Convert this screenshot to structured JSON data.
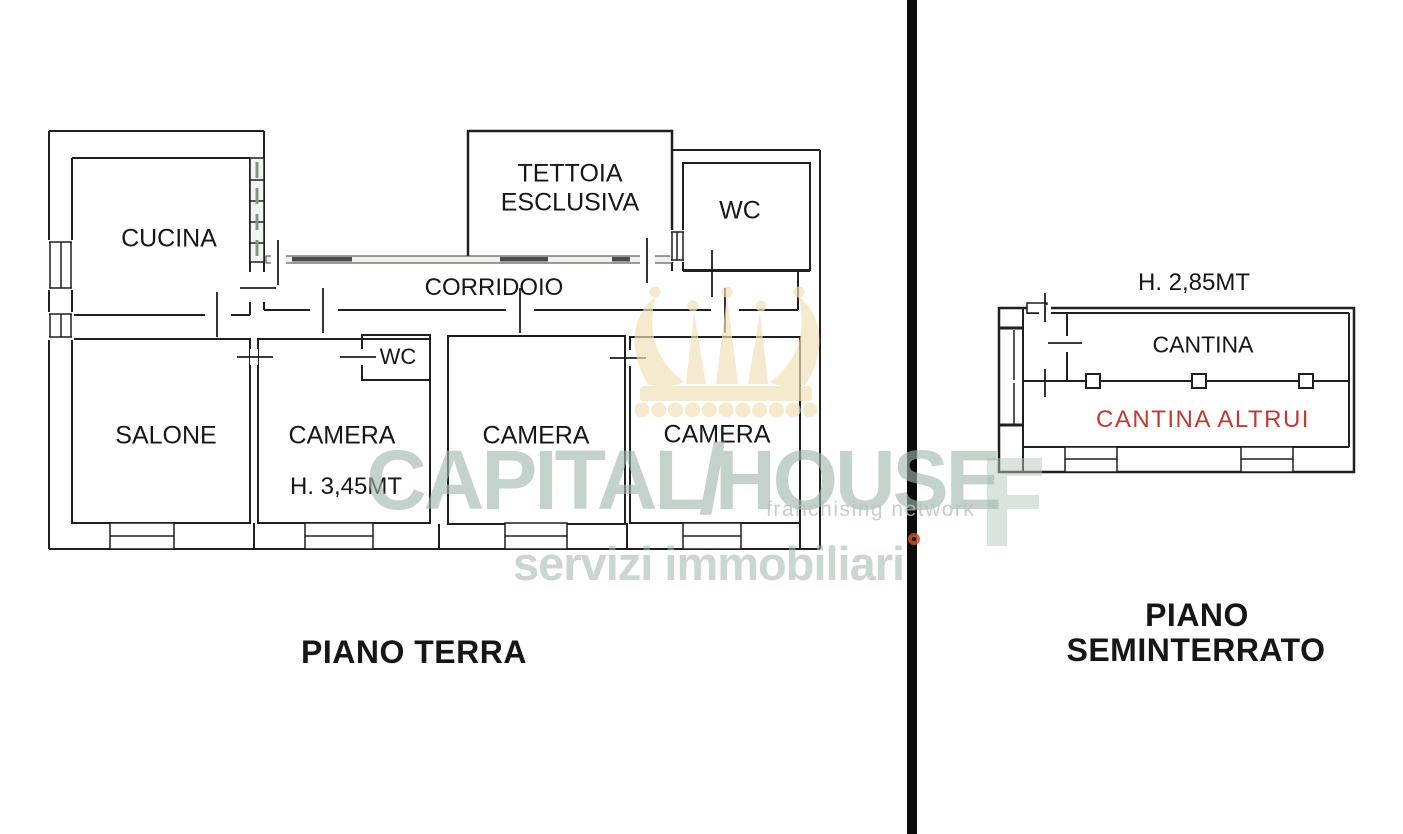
{
  "page": {
    "background": "#ffffff"
  },
  "divider": {
    "color": "#0b0b0b"
  },
  "ground_floor": {
    "title": "PIANO TERRA",
    "labels": {
      "cucina": "CUCINA",
      "tettoia_line1": "TETTOIA",
      "tettoia_line2": "ESCLUSIVA",
      "wc_top": "WC",
      "corridoio": "CORRIDOIO",
      "salone": "SALONE",
      "camera_1": "CAMERA",
      "wc_small": "WC",
      "height_note": "H. 3,45MT",
      "camera_2": "CAMERA",
      "camera_3": "CAMERA"
    }
  },
  "basement": {
    "title_line1": "PIANO",
    "title_line2": "SEMINTERRATO",
    "height_note": "H. 2,85MT",
    "labels": {
      "cantina": "CANTINA",
      "cantina_altrui": "CANTINA ALTRUI"
    },
    "cantina_altrui_color": "#c23a32"
  },
  "watermark": {
    "brand_left": "CAPITAL",
    "brand_slash": "/",
    "brand_right": "HOUSE",
    "tagline": "franchising network",
    "subtitle": "servizi immobiliari",
    "text_color": "#9fb7ac",
    "crown_color": "#f1dfb8",
    "accent_color": "#cd4f28"
  },
  "wall_color": "#1f1f1f"
}
